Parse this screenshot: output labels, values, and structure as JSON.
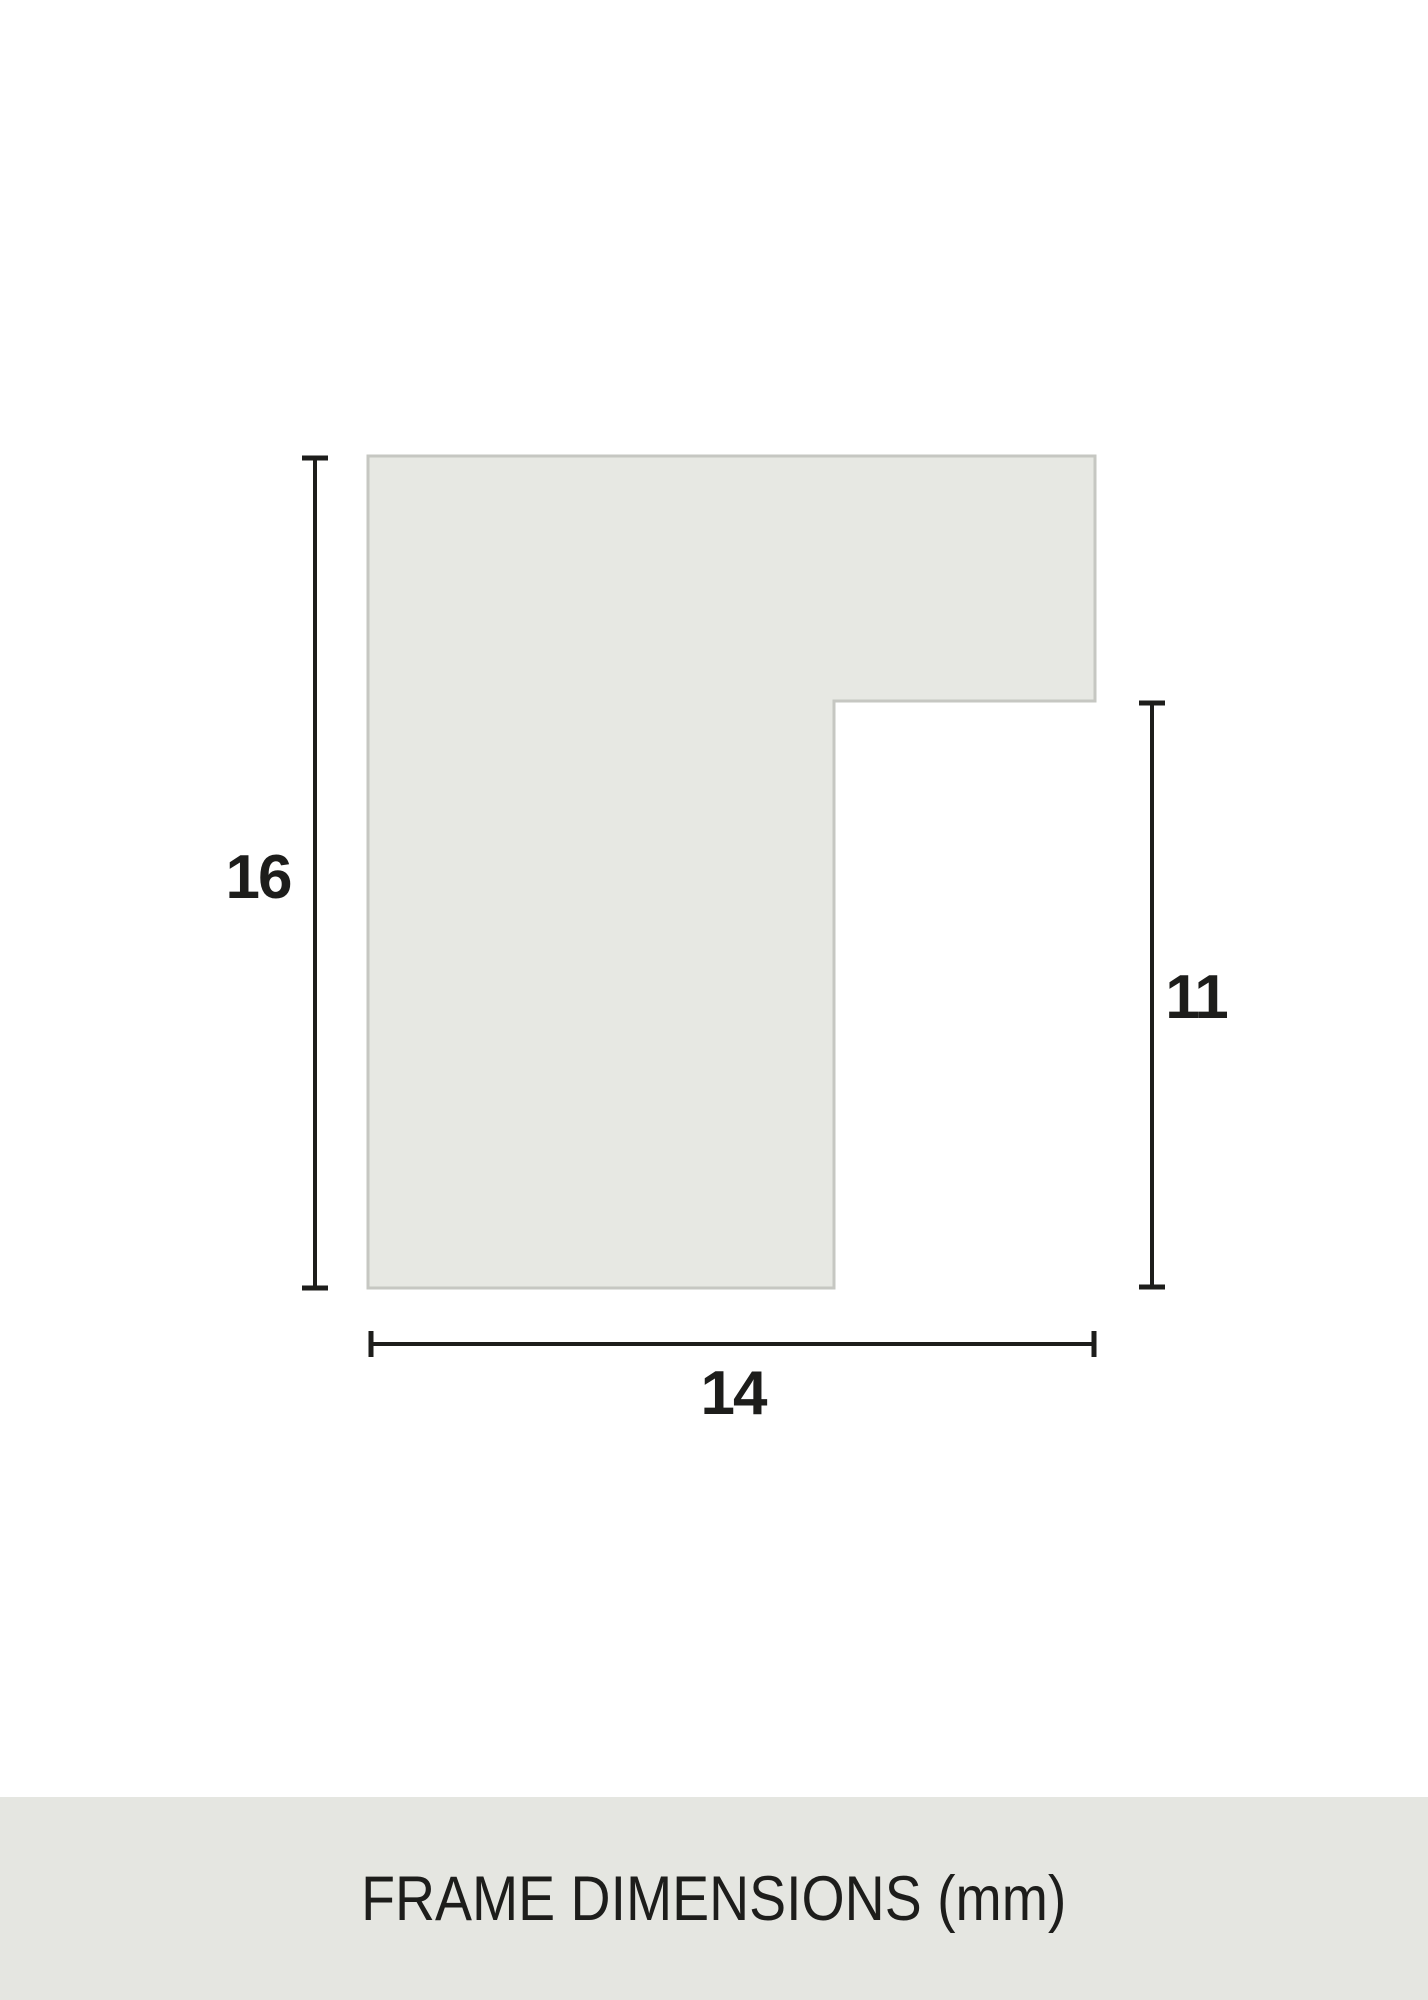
{
  "diagram": {
    "footer_title": "FRAME DIMENSIONS (mm)",
    "labels": {
      "height": "16",
      "inner_height": "11",
      "width": "14"
    },
    "colors": {
      "page_bg": "#ffffff",
      "profile_fill": "#e7e8e3",
      "profile_border": "#c6c7c2",
      "dimension_line": "#1d1d1b",
      "label_text": "#1d1d1b",
      "footer_bg": "#e5e6e1",
      "footer_text": "#1d1d1b"
    }
  }
}
